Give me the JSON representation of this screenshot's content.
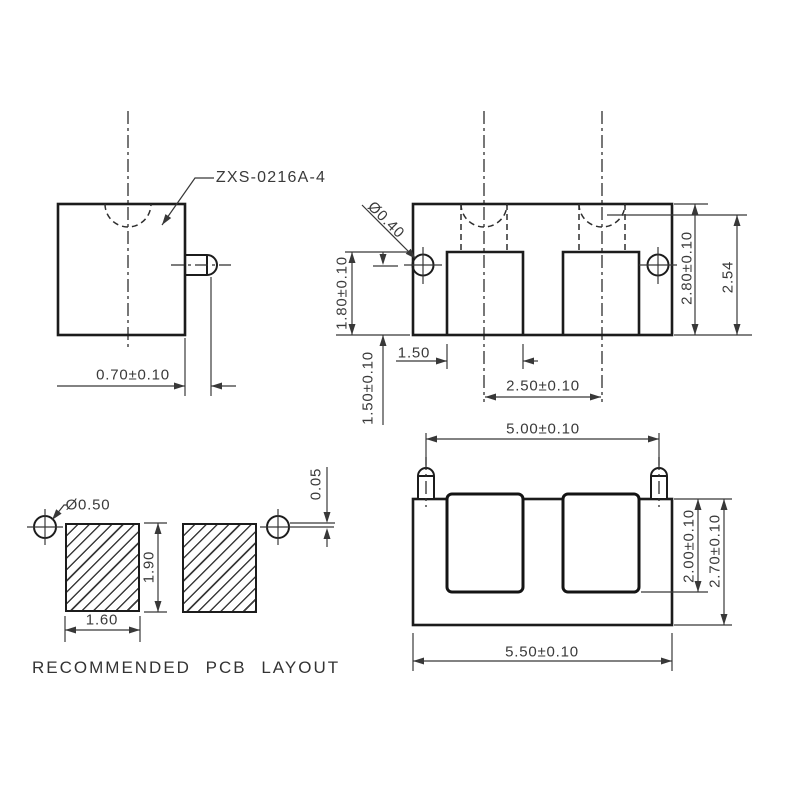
{
  "drawing": {
    "background": "#ffffff",
    "line_color": "#1c1c1c",
    "text_color": "#3a3a3a",
    "part_label": "ZXS-0216A-4",
    "side_view": {
      "pin_protrusion": "0.70±0.10"
    },
    "top_view": {
      "pin_diameter": "Ø0.40",
      "pad_depth": "1.80±0.10",
      "pin_length": "1.50±0.10",
      "pad_width": "1.50",
      "pad_pitch": "2.50±0.10",
      "body_depth": "2.80±0.10",
      "ref_depth": "2.54"
    },
    "front_view": {
      "pin_pitch": "5.00±0.10",
      "pad_height": "2.00±0.10",
      "body_height": "2.70±0.10",
      "body_width": "5.50±0.10"
    },
    "pcb_layout": {
      "hole_diameter": "Ø0.50",
      "pad_height": "1.90",
      "pad_width": "1.60",
      "edge_offset": "0.05",
      "caption": "RECOMMENDED PCB LAYOUT"
    }
  }
}
